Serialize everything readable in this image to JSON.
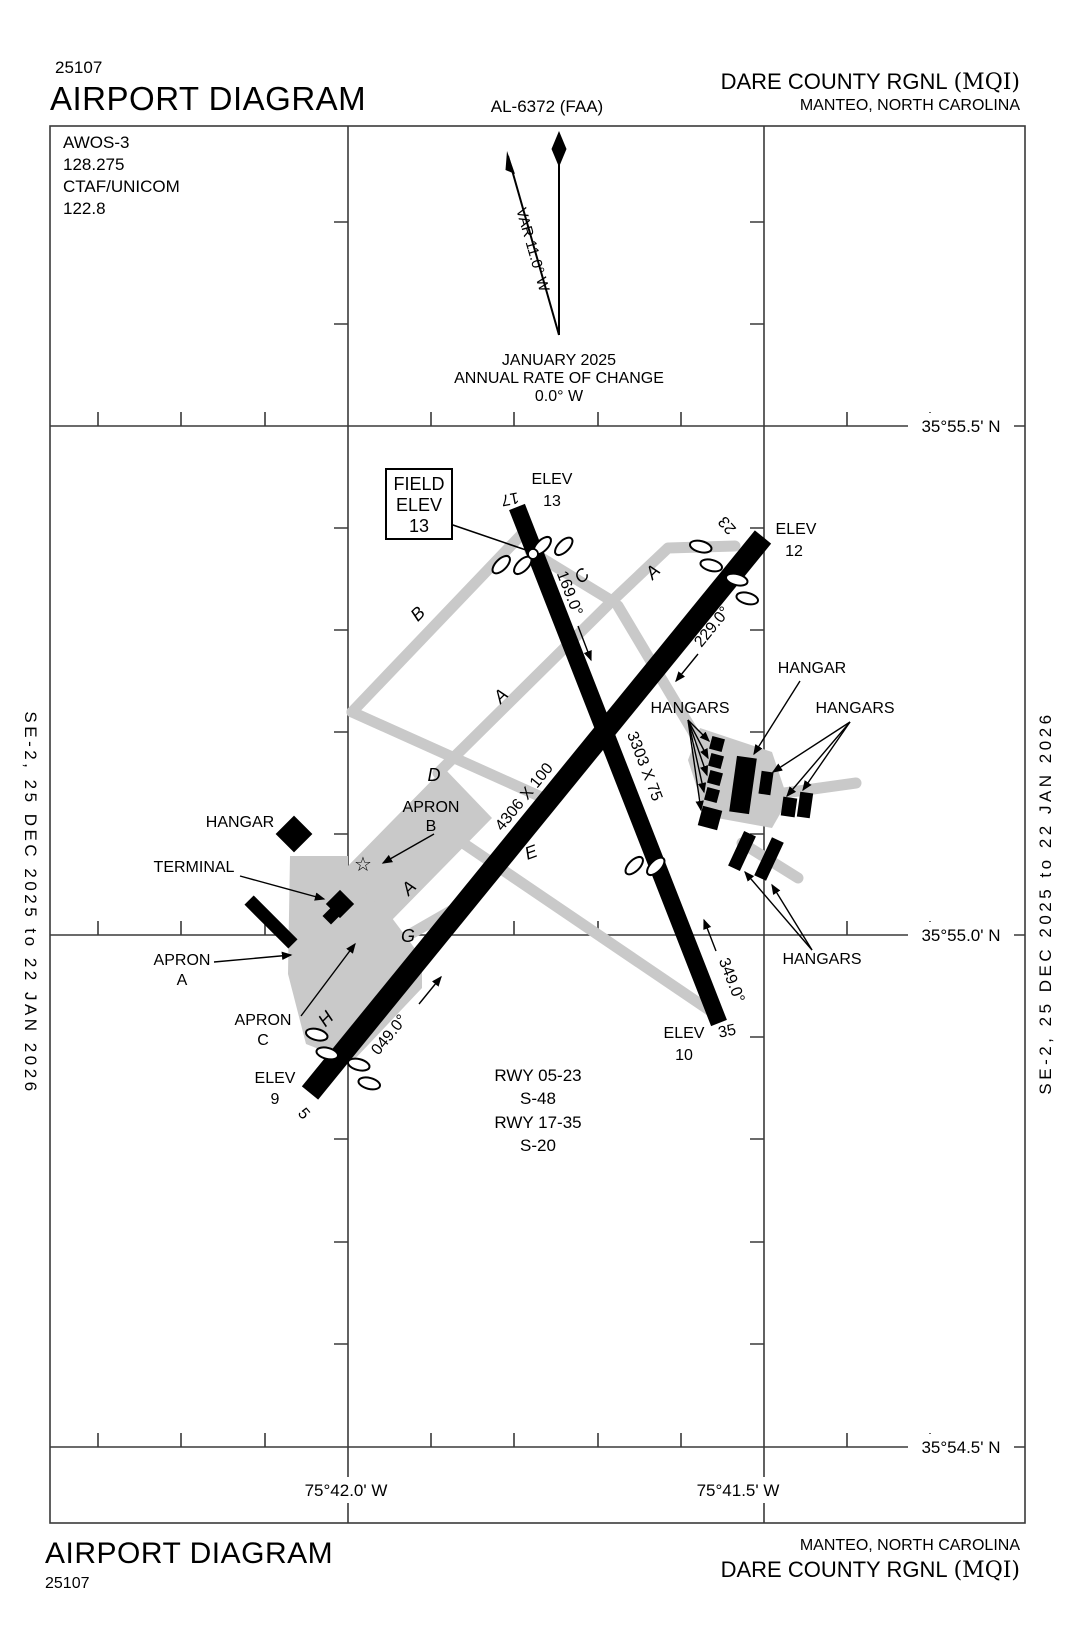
{
  "header": {
    "plate_code": "25107",
    "title": "AIRPORT DIAGRAM",
    "chart_id": "AL-6372 (FAA)",
    "airport_name": "DARE COUNTY RGNL",
    "airport_icao": "(MQI)",
    "city": "MANTEO, NORTH CAROLINA"
  },
  "footer": {
    "plate_code": "25107",
    "title": "AIRPORT DIAGRAM",
    "airport_name": "DARE COUNTY RGNL",
    "airport_icao": "(MQI)",
    "city": "MANTEO, NORTH CAROLINA"
  },
  "side_strip": {
    "text": "SE-2,  25 DEC 2025  to  22 JAN 2026"
  },
  "info_box": {
    "lines": [
      "AWOS-3",
      "128.275",
      "CTAF/UNICOM",
      "122.8"
    ]
  },
  "compass": {
    "variation": "VAR 11.0° W",
    "date": "JANUARY 2025",
    "rate_label": "ANNUAL RATE OF CHANGE",
    "rate_value": "0.0° W"
  },
  "grid": {
    "lat": [
      "35°55.5' N",
      "35°55.0' N",
      "35°54.5' N"
    ],
    "lon": [
      "75°42.0' W",
      "75°41.5' W"
    ]
  },
  "field_elev_box": {
    "line1": "FIELD",
    "line2": "ELEV",
    "line3": "13"
  },
  "runway_0523": {
    "num_5": "5",
    "num_23": "23",
    "dim": "4306 X 100",
    "hdg_05": "049.0°",
    "hdg_23": "229.0°"
  },
  "runway_1735": {
    "num_17": "17",
    "num_35": "35",
    "dim": "3303 X 75",
    "hdg_17": "169.0°",
    "hdg_35": "349.0°"
  },
  "elevations": {
    "label": "ELEV",
    "rwy17": "13",
    "rwy23": "12",
    "rwy35": "10",
    "rwy5": "9"
  },
  "taxiways": {
    "a": "A",
    "b": "B",
    "c": "C",
    "d": "D",
    "e": "E",
    "g": "G",
    "h": "H"
  },
  "facilities": {
    "hangar": "HANGAR",
    "hangars": "HANGARS",
    "terminal": "TERMINAL",
    "apron": "APRON",
    "apron_a": "A",
    "apron_b": "B",
    "apron_c": "C"
  },
  "rwy_data": {
    "lines": [
      "RWY 05-23",
      "S-48",
      "RWY 17-35",
      "S-20"
    ]
  },
  "colors": {
    "taxiway_gray": "#c9c9c9",
    "ink": "#000000"
  }
}
